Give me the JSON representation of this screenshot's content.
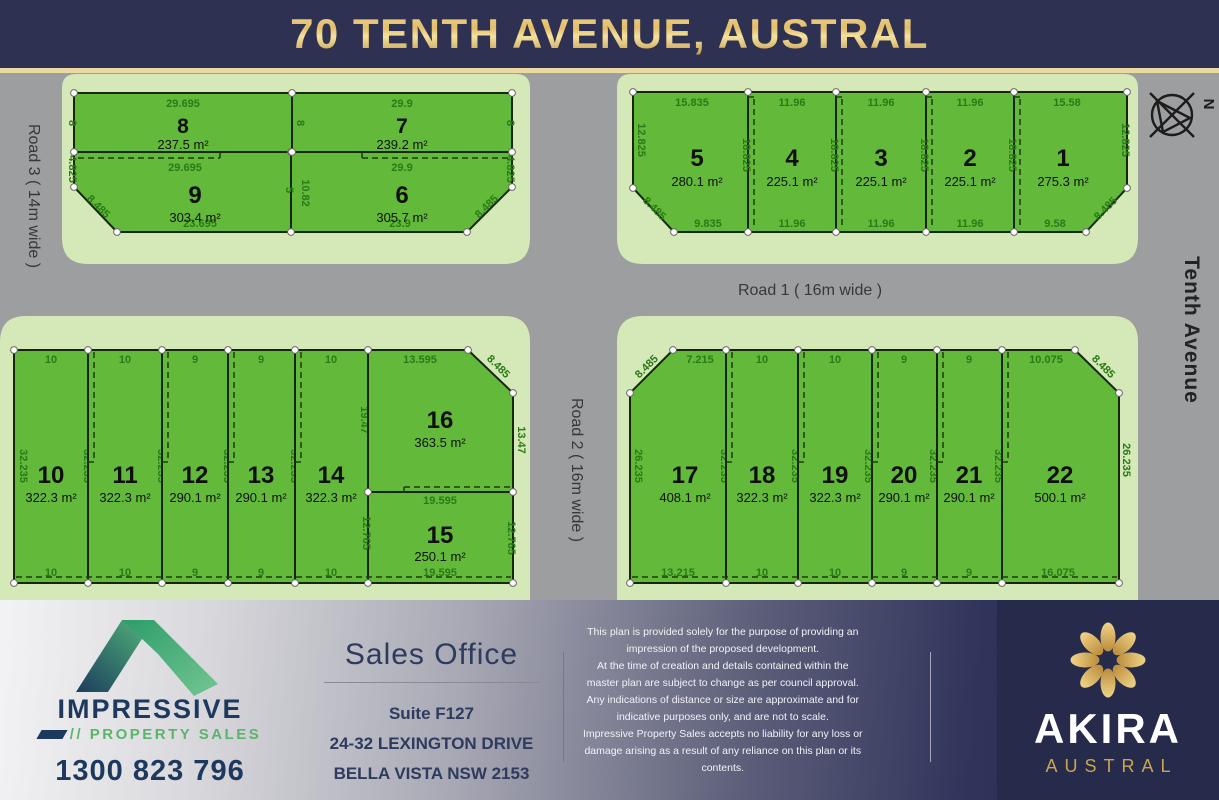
{
  "header": {
    "title": "70 TENTH AVENUE, AUSTRAL"
  },
  "plan": {
    "roads": {
      "road1": "Road 1 ( 16m wide )",
      "road2": "Road 2 ( 16m wide )",
      "road3": "Road 3 ( 14m wide )",
      "avenue": "Tenth Avenue"
    },
    "north_label": "N",
    "lots": [
      {
        "id": "1",
        "area": "275.3 m²",
        "dims": {
          "top": "15.58",
          "right": "12.825",
          "diag": "8.485",
          "bottom": "9.58"
        }
      },
      {
        "id": "2",
        "area": "225.1 m²",
        "dims": {
          "top": "11.96",
          "bottom": "11.96",
          "side": "18.825"
        }
      },
      {
        "id": "3",
        "area": "225.1 m²",
        "dims": {
          "top": "11.96",
          "bottom": "11.96",
          "side": "18.825"
        }
      },
      {
        "id": "4",
        "area": "225.1 m²",
        "dims": {
          "top": "11.96",
          "bottom": "11.96",
          "side": "18.825"
        }
      },
      {
        "id": "5",
        "area": "280.1 m²",
        "dims": {
          "top": "15.835",
          "left": "12.825",
          "diag": "8.485",
          "bottom": "9.835",
          "side": "18.825"
        }
      },
      {
        "id": "6",
        "area": "305.7 m²",
        "dims": {
          "top": "29.9",
          "left": "10.82",
          "right": "4.825",
          "diag": "8.485",
          "bottom": "23.9"
        }
      },
      {
        "id": "7",
        "area": "239.2 m²",
        "dims": {
          "top": "29.9",
          "left": "8",
          "right": "8"
        }
      },
      {
        "id": "8",
        "area": "237.5 m²",
        "dims": {
          "top": "29.695",
          "left": "8"
        }
      },
      {
        "id": "9",
        "area": "303.4 m²",
        "dims": {
          "top": "29.695",
          "left": "4.825",
          "diag": "8.485",
          "right": "5",
          "bottom": "23.695"
        }
      },
      {
        "id": "10",
        "area": "322.3 m²",
        "dims": {
          "top": "10",
          "bottom": "10",
          "left": "32.235",
          "right": "32.235"
        }
      },
      {
        "id": "11",
        "area": "322.3 m²",
        "dims": {
          "top": "10",
          "bottom": "10",
          "right": "32.235"
        }
      },
      {
        "id": "12",
        "area": "290.1 m²",
        "dims": {
          "top": "9",
          "bottom": "9",
          "right": "32.235"
        }
      },
      {
        "id": "13",
        "area": "290.1 m²",
        "dims": {
          "top": "9",
          "bottom": "9",
          "right": "32.235"
        }
      },
      {
        "id": "14",
        "area": "322.3 m²",
        "dims": {
          "top": "10",
          "bottom": "10",
          "right": "19.47"
        }
      },
      {
        "id": "15",
        "area": "250.1 m²",
        "dims": {
          "top": "19.595",
          "left": "12.765",
          "right": "12.765",
          "bottom": "19.595"
        }
      },
      {
        "id": "16",
        "area": "363.5 m²",
        "dims": {
          "top": "13.595",
          "diag": "8.485",
          "right": "13.47"
        }
      },
      {
        "id": "17",
        "area": "408.1 m²",
        "dims": {
          "top": "7.215",
          "diag": "8.485",
          "left": "26.235",
          "right": "32.235",
          "bottom": "13.215"
        }
      },
      {
        "id": "18",
        "area": "322.3 m²",
        "dims": {
          "top": "10",
          "bottom": "10",
          "right": "32.235"
        }
      },
      {
        "id": "19",
        "area": "322.3 m²",
        "dims": {
          "top": "10",
          "bottom": "10",
          "right": "32.235"
        }
      },
      {
        "id": "20",
        "area": "290.1 m²",
        "dims": {
          "top": "9",
          "bottom": "9",
          "right": "32.235"
        }
      },
      {
        "id": "21",
        "area": "290.1 m²",
        "dims": {
          "top": "9",
          "bottom": "9",
          "right": "32.235"
        }
      },
      {
        "id": "22",
        "area": "500.1 m²",
        "dims": {
          "top": "10.075",
          "diag": "8.485",
          "right": "26.235",
          "bottom": "16.075"
        }
      }
    ]
  },
  "footer": {
    "agency": {
      "name": "IMPRESSIVE",
      "tagline": "// PROPERTY SALES",
      "phone": "1300 823 796"
    },
    "sales_office": {
      "heading": "Sales Office",
      "line1": "Suite F127",
      "line2": "24-32 LEXINGTON DRIVE",
      "line3": "BELLA VISTA NSW 2153"
    },
    "disclaimer": "This plan is provided solely for the purpose of providing an\nimpression of the proposed development.\nAt the time of creation and details contained within the\nmaster plan are subject to change as per council approval.\nAny indications of distance or size are approximate and for\nindicative purposes only, and are not to scale.\nImpressive Property Sales accepts no liability for any loss or\ndamage arising as a result of any reliance on this plan or its\ncontents.",
    "brand": {
      "name": "AKIRA",
      "subname": "AUSTRAL"
    }
  },
  "colors": {
    "header_navy": "#2e3152",
    "title_gold": "#e3bd6a",
    "road_gray": "#9d9ea0",
    "verge_green": "#d5e8b8",
    "lot_green": "#62b93a",
    "dim_text_green": "#2b7a17",
    "brand_navy": "#262a4b",
    "brand_gold": "#c9a64e",
    "agency_navy": "#1d3a5e",
    "agency_green": "#5ab56a"
  }
}
